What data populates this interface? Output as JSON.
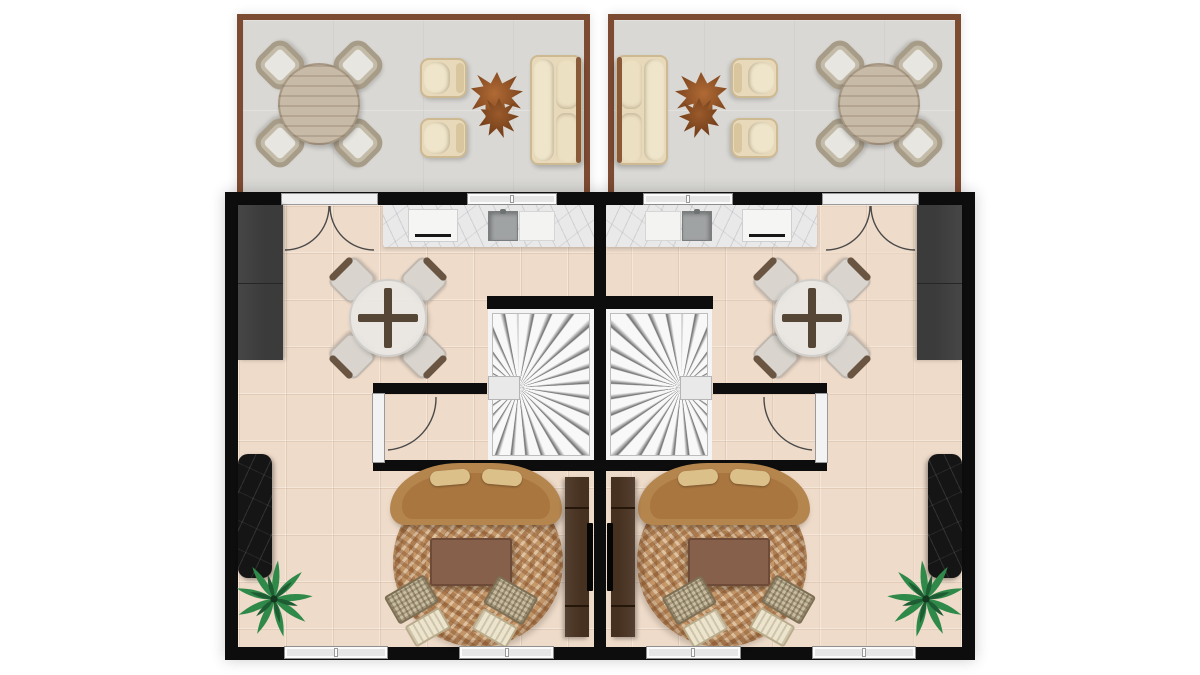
{
  "palette": {
    "background": "#ffffff",
    "wall": "#0d0d0d",
    "terrace_border": "#7d4b31",
    "terrace_floor": "#d9d8d4",
    "tile_floor": "#efdbc9",
    "marble_counter": "#e9e9ea",
    "cabinet_dark": "#3b3b3b",
    "stair_tread": "#efefef",
    "sofa_tan": "#b5854e",
    "sofa_seat": "#a9763f",
    "rug_base": "#c5986a",
    "wood_console": "#46301f",
    "stone_black": "#151515",
    "outdoor_wood": "#c7baa7",
    "outdoor_cream": "#e7d9ba",
    "wicker": "#b2a795",
    "chair_gray": "#d9d5ce",
    "leaf_table_rust": "#9c5a2e",
    "palm_green_light": "#2f8a4a",
    "palm_green_dark": "#1e5c33",
    "door_line": "#4a4a4a"
  },
  "plan": {
    "type": "residential-floor-plan",
    "rendering": "top-down-3d",
    "text_labels": [],
    "terraces": [
      {
        "id": "terrace-left",
        "furniture": [
          "round-outdoor-dining-table",
          "wicker-chair-x4",
          "outdoor-armchair-x2",
          "organic-leaf-coffee-table-x2",
          "outdoor-sofa"
        ]
      },
      {
        "id": "terrace-right",
        "mirror_of": "terrace-left"
      }
    ],
    "units": [
      {
        "id": "unit-left",
        "openings": [
          "double-french-door-to-terrace",
          "kitchen-window",
          "interior-single-door",
          "rear-window-1",
          "rear-window-2"
        ],
        "furniture": [
          "kitchen-counter-marble",
          "cooktop",
          "sink",
          "cutting-board",
          "tall-dark-cabinet",
          "round-glass-dining-table",
          "dining-chair-x4",
          "winder-staircase",
          "curved-tan-sofa",
          "round-mottled-rug",
          "rectangular-coffee-table",
          "woven-lounge-chair-x2",
          "tv-console",
          "wall-tv",
          "black-stone-console",
          "palm-plant"
        ]
      },
      {
        "id": "unit-right",
        "mirror_of": "unit-left"
      }
    ]
  }
}
